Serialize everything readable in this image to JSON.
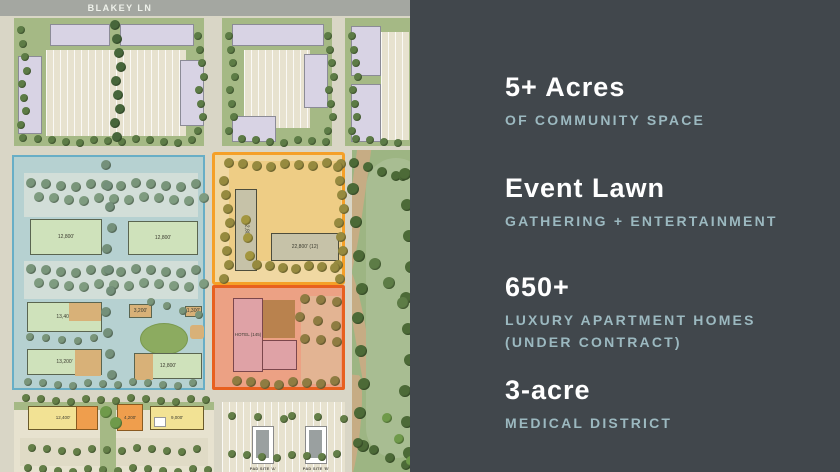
{
  "slide": {
    "panel": {
      "background": "#41474c",
      "accent_text_color": "#9cb9c0",
      "stats": [
        {
          "value": "5+ Acres",
          "label": "OF COMMUNITY SPACE"
        },
        {
          "value": "Event Lawn",
          "label": "GATHERING + ENTERTAINMENT"
        },
        {
          "value": "650+",
          "label": "LUXURY APARTMENT HOMES (UNDER CONTRACT)"
        },
        {
          "value": "3-acre",
          "label": "MEDICAL DISTRICT"
        }
      ]
    },
    "site_plan": {
      "street_label": "BLAKEY LN",
      "zones": {
        "community": {
          "outline_color": "#68aec6",
          "buildings": [
            "12,800'",
            "12,800'",
            "13,400'",
            "3,200'",
            "1,300'",
            "13,200'",
            "12,800'"
          ]
        },
        "entertainment": {
          "outline_color": "#f5a028",
          "buildings": [
            "12,800'",
            "22,800' (12)"
          ]
        },
        "hotel": {
          "outline_color": "#e8601f",
          "building": "HOTEL (145)"
        }
      },
      "retail_buildings": [
        "12,400'",
        "4,200'",
        "9,000'"
      ],
      "pad_sites": [
        "PAD SITE 'A'",
        "PAD SITE 'B'"
      ]
    }
  }
}
